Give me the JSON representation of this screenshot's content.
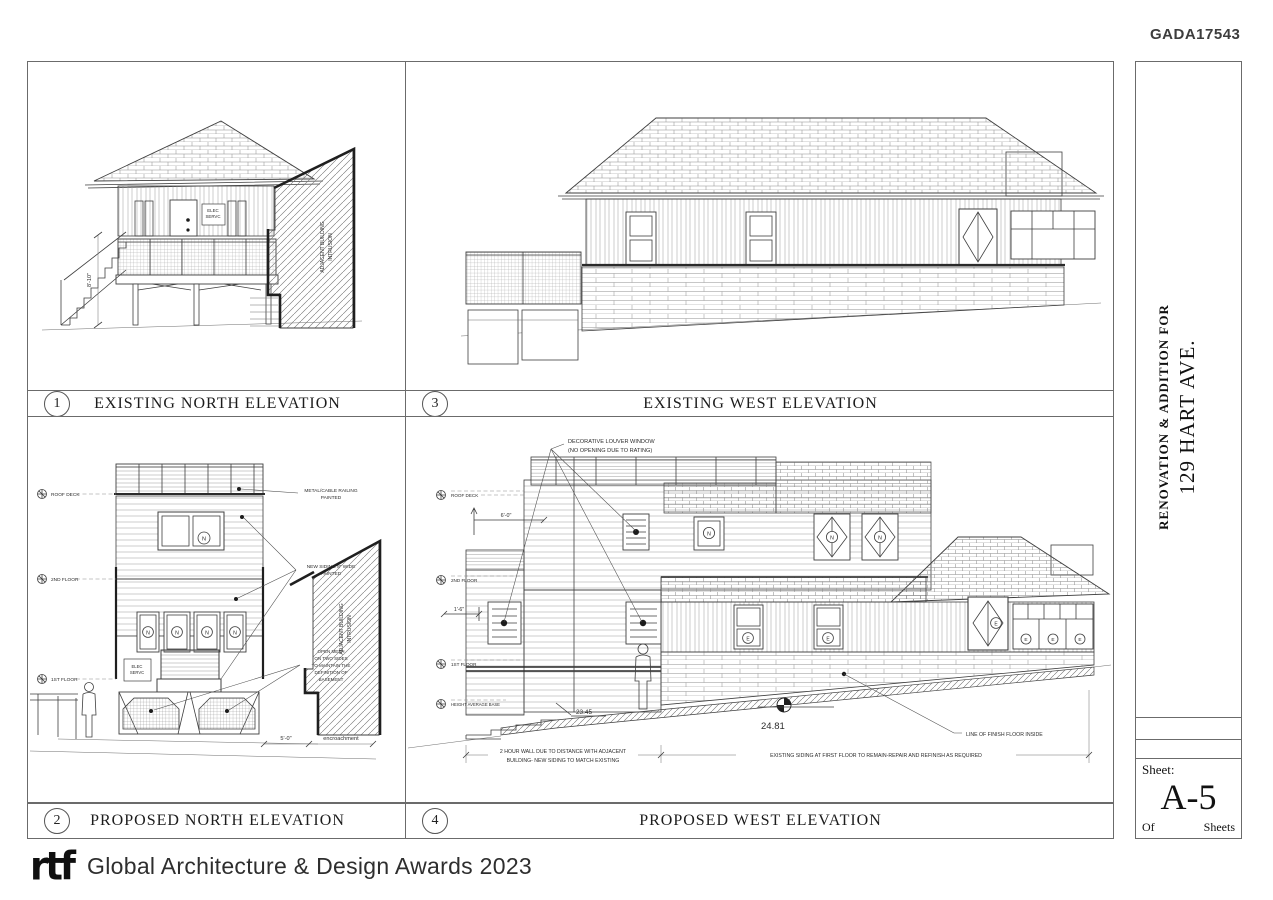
{
  "header": {
    "project_code": "GADA17543"
  },
  "titleblock": {
    "project_line1": "RENOVATION & ADDITION FOR",
    "project_line2": "129 HART AVE.",
    "sheet_label": "Sheet:",
    "sheet_number": "A-5",
    "of_label": "Of",
    "sheets_label": "Sheets"
  },
  "footer": {
    "logo_text": "rtf",
    "award_text": "Global Architecture & Design Awards 2023"
  },
  "tags": {
    "new": "N",
    "existing": "E"
  },
  "panel1": {
    "number": "1",
    "title": "EXISTING NORTH ELEVATION",
    "elec_line1": "ELEC",
    "elec_line2": "SERVC",
    "height_dim": "8'-10\"",
    "intrusion_line1": "ADJACENT BUILDING",
    "intrusion_line2": "INTRUSION"
  },
  "panel3": {
    "number": "3",
    "title": "EXISTING WEST ELEVATION"
  },
  "panel2": {
    "number": "2",
    "title": "PROPOSED NORTH ELEVATION",
    "levels": {
      "roof_deck": "ROOF DECK",
      "second_floor": "2ND FLOOR",
      "first_floor": "1ST FLOOR"
    },
    "elec_line1": "ELEC",
    "elec_line2": "SERVC",
    "callout_railing_l1": "METAL/CABLE RAILING",
    "callout_railing_l2": "PAINTED",
    "callout_siding_l1": "NEW SIDING 8\" WIDE",
    "callout_siding_l2": "PAINTED",
    "callout_mesh_l1": "OPEN MESH",
    "callout_mesh_l2": "ON TWO SIDES",
    "callout_mesh_l3": "TO MAINTAIN THE",
    "callout_mesh_l4": "DEFINITION OF",
    "callout_mesh_l5": "BASEMENT",
    "dim_width": "5'-0\"",
    "encroachment": "encroachment",
    "intrusion_line1": "ADJACENT BUILDING",
    "intrusion_line2": "INTRUSION"
  },
  "panel4": {
    "number": "4",
    "title": "PROPOSED WEST ELEVATION",
    "louver_l1": "DECORATIVE LOUVER WINDOW",
    "louver_l2": "(NO OPENING DUE TO RATING)",
    "levels": {
      "roof_deck": "ROOF DECK",
      "second_floor": "2ND FLOOR",
      "first_floor": "1ST FLOOR",
      "base": "HEIGHT AVERAGE BASE"
    },
    "dim_top": "6'-0\"",
    "dim_mid": "1'-6\"",
    "spot_low": "23.45",
    "spot_high": "24.81",
    "note_wall_l1": "2 HOUR WALL DUE TO DISTANCE WITH ADJACENT",
    "note_wall_l2": "BUILDING- NEW SIDING TO MATCH EXISTING",
    "note_siding": "EXISTING SIDING AT FIRST FLOOR TO REMAIN-REPAIR AND REFINISH AS REQUIRED",
    "note_floor": "LINE OF FINISH FLOOR INSIDE"
  }
}
